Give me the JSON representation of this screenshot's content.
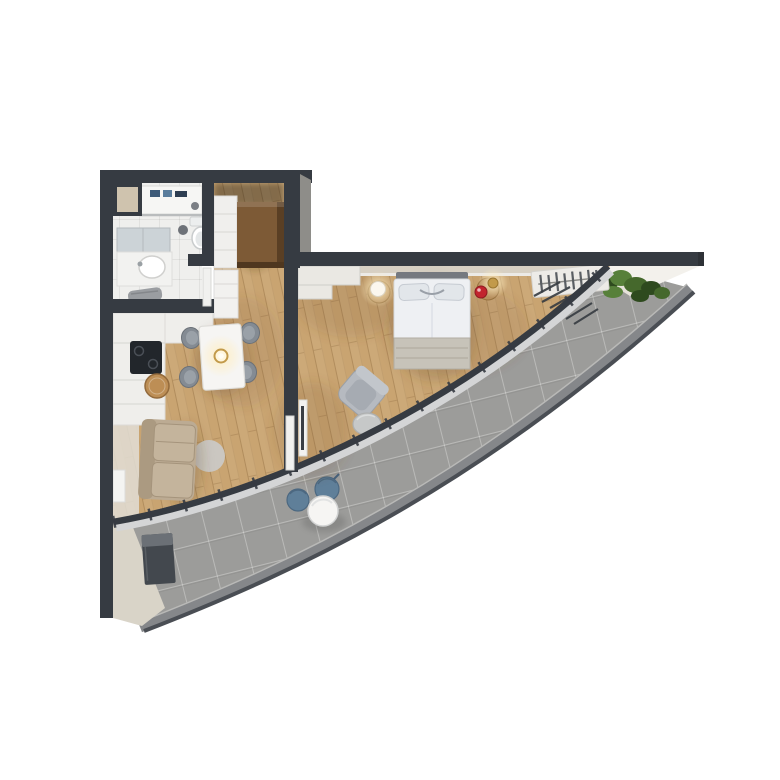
{
  "scene": {
    "type": "3d-apartment-floor-plan-render",
    "background": "#ffffff",
    "rooms": [
      "bathroom",
      "entry-hall",
      "kitchen-dining",
      "living-area",
      "bedroom",
      "curved-terrace"
    ],
    "furniture": [
      "shower",
      "toilet",
      "vanity-sink",
      "bath-mat",
      "hall-closet",
      "hall-wardrobe",
      "kitchen-counter",
      "cooktop",
      "cutting-board",
      "tall-cabinet",
      "dining-table",
      "dining-chair",
      "pendant-lamp",
      "sofa",
      "round-rug",
      "wall-radiator",
      "double-bed",
      "pillows",
      "bedside-table-left",
      "bedside-table-right",
      "bedside-lamp-left",
      "bedside-lamp-right",
      "red-mug",
      "armchair",
      "side-table",
      "tv-console",
      "pocket-door",
      "open-wardrobe",
      "window-wall",
      "terrace-chair",
      "terrace-coffee-table",
      "planter-box",
      "hedge"
    ],
    "counts": {
      "dining_chairs": 4,
      "terrace_chairs": 2,
      "bedside_lamps": 2
    }
  },
  "palette": {
    "background": "#ffffff",
    "wall": "#363b42",
    "wallFace": "#8e8d89",
    "wood": "#c9a471",
    "woodLine": "#7c5a2e",
    "bathFloor": "#efefed",
    "bathLine": "#dddddad",
    "tile": "#9c9c9a",
    "rim": "#85878a",
    "rimEdge": "#4a4e54",
    "beigeWall": "#d7d0c3",
    "exteriorWhite": "#f3f1ec",
    "exteriorBeige": "#d9d4c8",
    "hedgeDark": "#2e4a1e",
    "hedgeMid": "#45682c",
    "hedgeLight": "#57803a",
    "bedWhite": "#eef0f3",
    "blanket": "#c7c3b9",
    "headboard": "#75797f",
    "pillow": "#e2e6ea",
    "sofa": "#bcab93",
    "sofaSeam": "#a5947c",
    "rug": "#cbcac8",
    "chairGray": "#848b93",
    "tableWhite": "#f6f5f3",
    "blueChair": "#5f7f99",
    "brass": "#c29a4a",
    "glow": "#ffeec2",
    "red": "#c2242e",
    "brownWardrobe": "#7d5a36",
    "closetWhite": "#f0efed",
    "counter": "#efeeeb",
    "cooktop": "#22262b",
    "board": "#bd8e55",
    "planter": "#43484e",
    "glass": "#d4d5d6"
  }
}
